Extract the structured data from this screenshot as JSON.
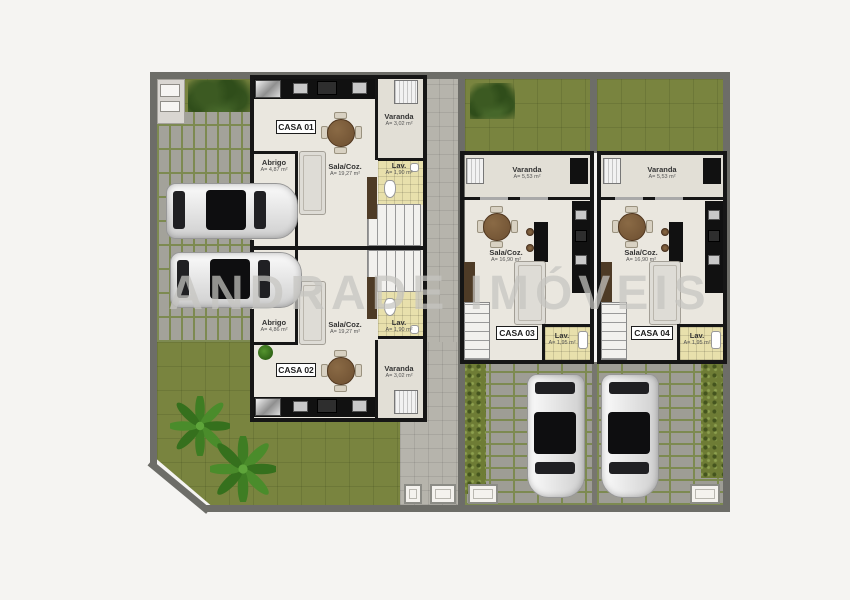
{
  "watermark": "ANDRADE IMÓVEIS",
  "units": [
    {
      "label": "CASA 01",
      "varanda_name": "Varanda",
      "varanda_area": "A= 3,02 m²",
      "sala_name": "Sala/Coz.",
      "sala_area": "A= 19,27 m²",
      "abrigo_name": "Abrigo",
      "abrigo_area": "A= 4,87 m²",
      "lav_name": "Lav.",
      "lav_area": "A= 1,90 m²"
    },
    {
      "label": "CASA 02",
      "varanda_name": "Varanda",
      "varanda_area": "A= 3,02 m²",
      "sala_name": "Sala/Coz.",
      "sala_area": "A= 19,27 m²",
      "abrigo_name": "Abrigo",
      "abrigo_area": "A= 4,86 m²",
      "lav_name": "Lav.",
      "lav_area": "A= 1,90 m²"
    },
    {
      "label": "CASA 03",
      "varanda_name": "Varanda",
      "varanda_area": "A= 5,53 m²",
      "sala_name": "Sala/Coz.",
      "sala_area": "A= 16,90 m²",
      "lav_name": "Lav.",
      "lav_area": "A= 1,95 m²"
    },
    {
      "label": "CASA 04",
      "varanda_name": "Varanda",
      "varanda_area": "A= 5,53 m²",
      "sala_name": "Sala/Coz.",
      "sala_area": "A= 16,90 m²",
      "lav_name": "Lav.",
      "lav_area": "A= 1,95 m²"
    }
  ],
  "colors": {
    "background": "#f5f4f2",
    "grass": "#79843f",
    "paver": "#a3a29a",
    "paver_joint": "#7d8a51",
    "wall": "#161616",
    "floor": "#eae7df",
    "lav_tile": "#e8e0ac",
    "fence": "#6d6d68",
    "table_wood": "#7b5b3a",
    "watermark_gray": "#c6c5c1",
    "car_body": "#e8e8e8",
    "car_glass": "#1d1d1f"
  }
}
